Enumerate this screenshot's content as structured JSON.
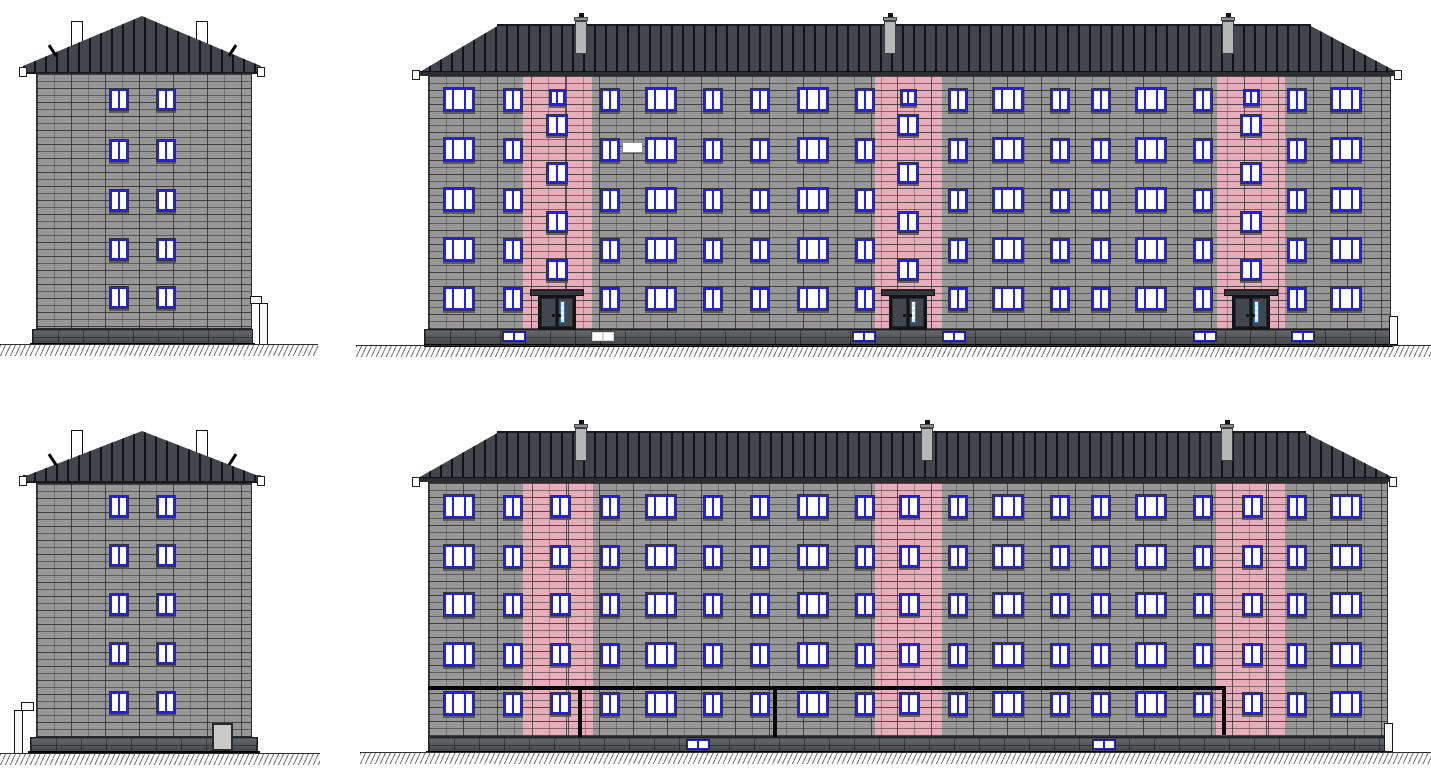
{
  "title": "Five-storey panel apartment building - elevation drawings: end elevation, street (entrance) elevation, opposite end elevation, rear elevation with gas pipe",
  "colors": {
    "wall_panel": "#979797",
    "panel_joint": "#3f3f3f",
    "stairwell_accent": "#e7adbb",
    "roof": "#43474d",
    "roof_seam": "#15171a",
    "fascia": "#2a2d32",
    "window_frame": "#2322e0",
    "window_pane": "#ffffff",
    "door_leaf": "#42474d",
    "door_glazing": "#cfe6f4",
    "plinth": "#54575b",
    "chimney": "#ffffff",
    "vent": "#b5b7b9",
    "gas_pipe": "#050505",
    "ground_line": "#2e2e2e"
  },
  "views": [
    {
      "id": "end-elevation-top",
      "kind": "end",
      "roof": {
        "tri": {
          "x": 23,
          "y": 16,
          "w": 238,
          "h": 50
        },
        "band": {
          "x": 23,
          "y": 66,
          "w": 238,
          "h": 8
        }
      },
      "chimneys": [
        {
          "x": 71,
          "y": 21,
          "w": 12,
          "h": 30
        },
        {
          "x": 196,
          "y": 21,
          "w": 12,
          "h": 30
        }
      ],
      "hooks": [
        {
          "x": 51,
          "y": 44,
          "rot": -33
        },
        {
          "x": 231,
          "y": 44,
          "rot": 33
        }
      ],
      "gutter_caps": [
        {
          "x": 19,
          "y": 67,
          "w": 8,
          "h": 10
        },
        {
          "x": 257,
          "y": 67,
          "w": 8,
          "h": 10
        }
      ],
      "wall": {
        "x": 36,
        "y": 73,
        "w": 216,
        "h": 256
      },
      "window_cols": [
        109,
        156
      ],
      "window": {
        "w": 20,
        "h": 23
      },
      "floors": [
        88,
        139,
        189,
        238,
        286
      ],
      "plinth": {
        "x": 32,
        "y": 329,
        "w": 221,
        "h": 15
      },
      "base_line": {
        "x": 30,
        "y": 343,
        "w": 225,
        "h": 2
      },
      "downspout": {
        "pipe": {
          "x": 259,
          "y": 303,
          "w": 9,
          "h": 42
        },
        "elbow": {
          "x": 250,
          "y": 296,
          "w": 12,
          "h": 8
        }
      },
      "ground": {
        "x": 0,
        "y": 344,
        "w": 318,
        "h": 12
      }
    },
    {
      "id": "front-elevation",
      "kind": "long",
      "roof": {
        "x": 418,
        "y": 25,
        "w": 981,
        "h": 48,
        "inset_left": 81,
        "inset_right": 90
      },
      "ridge": {
        "x": 497,
        "y": 24,
        "w": 814,
        "h": 2
      },
      "vents": [
        {
          "x": 575
        },
        {
          "x": 884
        },
        {
          "x": 1222
        }
      ],
      "vent_y": 19,
      "fascia": {
        "x": 418,
        "y": 71,
        "w": 981,
        "h": 5
      },
      "gutter_caps": [
        {
          "x": 412,
          "y": 70,
          "w": 8,
          "h": 10
        },
        {
          "x": 1394,
          "y": 70,
          "w": 8,
          "h": 10
        }
      ],
      "wall": {
        "x": 428,
        "y": 75,
        "w": 963,
        "h": 255
      },
      "stripes": [
        {
          "x": 523,
          "w": 69
        },
        {
          "x": 875,
          "w": 67
        },
        {
          "x": 1217,
          "w": 68
        }
      ],
      "window_cols": [
        {
          "x": 443,
          "t": 3
        },
        {
          "x": 503,
          "t": 2
        },
        {
          "x": 600,
          "t": 2
        },
        {
          "x": 645,
          "t": 3
        },
        {
          "x": 703,
          "t": 2
        },
        {
          "x": 750,
          "t": 2
        },
        {
          "x": 797,
          "t": 3
        },
        {
          "x": 855,
          "t": 2
        },
        {
          "x": 948,
          "t": 2
        },
        {
          "x": 992,
          "t": 3
        },
        {
          "x": 1050,
          "t": 2
        },
        {
          "x": 1091,
          "t": 2
        },
        {
          "x": 1135,
          "t": 3
        },
        {
          "x": 1193,
          "t": 2
        },
        {
          "x": 1287,
          "t": 2
        },
        {
          "x": 1330,
          "t": 3
        }
      ],
      "floors": [
        88,
        138,
        188,
        238,
        287
      ],
      "window_sizes": {
        "wide": {
          "w": 32,
          "h": 25
        },
        "narrow": {
          "w": 20,
          "h": 24
        }
      },
      "stair": {
        "mode": "offset",
        "centers": [
          557,
          908,
          1251
        ],
        "w": 22,
        "h": 22,
        "ys": [
          114,
          162,
          211,
          259
        ],
        "top_small": {
          "w": 17,
          "h": 17,
          "y": 89
        }
      },
      "doors": {
        "centers": [
          557,
          908,
          1251
        ],
        "w": 38,
        "y": 295,
        "h": 35,
        "canopy_w": 54,
        "canopy_y": 289,
        "canopy_h": 7
      },
      "blank_patch": {
        "x": 622,
        "y": 142,
        "w": 21,
        "h": 11
      },
      "plinth": {
        "x": 424,
        "y": 329,
        "w": 969,
        "h": 16
      },
      "base_line": {
        "x": 424,
        "y": 344,
        "w": 969,
        "h": 3
      },
      "basement_y": 331,
      "basement_windows": [
        {
          "x": 502,
          "style": "blue"
        },
        {
          "x": 591,
          "style": "white"
        },
        {
          "x": 852,
          "style": "blue"
        },
        {
          "x": 942,
          "style": "blue"
        },
        {
          "x": 1193,
          "style": "blue"
        },
        {
          "x": 1291,
          "style": "blue"
        }
      ],
      "downspout": {
        "pipe": {
          "x": 1389,
          "y": 316,
          "w": 9,
          "h": 29
        }
      },
      "ground": {
        "x": 356,
        "y": 345,
        "w": 1075,
        "h": 12
      }
    },
    {
      "id": "end-elevation-bottom",
      "kind": "end",
      "roof": {
        "tri": {
          "x": 23,
          "y": 431,
          "w": 238,
          "h": 46
        },
        "band": {
          "x": 23,
          "y": 475,
          "w": 238,
          "h": 8
        }
      },
      "chimneys": [
        {
          "x": 71,
          "y": 430,
          "w": 12,
          "h": 30
        },
        {
          "x": 196,
          "y": 430,
          "w": 12,
          "h": 30
        }
      ],
      "hooks": [
        {
          "x": 51,
          "y": 453,
          "rot": -33
        },
        {
          "x": 231,
          "y": 453,
          "rot": 33
        }
      ],
      "gutter_caps": [
        {
          "x": 19,
          "y": 476,
          "w": 8,
          "h": 10
        },
        {
          "x": 257,
          "y": 476,
          "w": 8,
          "h": 10
        }
      ],
      "wall": {
        "x": 36,
        "y": 483,
        "w": 216,
        "h": 254
      },
      "window_cols": [
        109,
        156
      ],
      "window": {
        "w": 20,
        "h": 23
      },
      "floors": [
        495,
        544,
        593,
        642,
        691
      ],
      "plinth": {
        "x": 30,
        "y": 737,
        "w": 228,
        "h": 15
      },
      "base_line": {
        "x": 28,
        "y": 751,
        "w": 232,
        "h": 2
      },
      "hatch_door": {
        "x": 212,
        "y": 723,
        "w": 21,
        "h": 28
      },
      "downspout": {
        "pipe": {
          "x": 14,
          "y": 710,
          "w": 9,
          "h": 44
        },
        "elbow": {
          "x": 21,
          "y": 702,
          "w": 13,
          "h": 9
        }
      },
      "ground": {
        "x": 0,
        "y": 753,
        "w": 320,
        "h": 12
      }
    },
    {
      "id": "rear-elevation",
      "kind": "long",
      "roof": {
        "x": 418,
        "y": 432,
        "w": 976,
        "h": 46,
        "inset_left": 81,
        "inset_right": 90
      },
      "ridge": {
        "x": 497,
        "y": 431,
        "w": 809,
        "h": 2
      },
      "vents": [
        {
          "x": 575
        },
        {
          "x": 921
        },
        {
          "x": 1221
        }
      ],
      "vent_y": 426,
      "fascia": {
        "x": 418,
        "y": 477,
        "w": 976,
        "h": 5
      },
      "gutter_caps": [
        {
          "x": 412,
          "y": 477,
          "w": 8,
          "h": 10
        },
        {
          "x": 1389,
          "y": 477,
          "w": 8,
          "h": 10
        }
      ],
      "wall": {
        "x": 428,
        "y": 482,
        "w": 960,
        "h": 255
      },
      "stripes": [
        {
          "x": 523,
          "w": 70
        },
        {
          "x": 875,
          "w": 67
        },
        {
          "x": 1215,
          "w": 70
        }
      ],
      "window_cols": [
        {
          "x": 443,
          "t": 3
        },
        {
          "x": 503,
          "t": 2
        },
        {
          "x": 600,
          "t": 2
        },
        {
          "x": 645,
          "t": 3
        },
        {
          "x": 703,
          "t": 2
        },
        {
          "x": 750,
          "t": 2
        },
        {
          "x": 797,
          "t": 3
        },
        {
          "x": 855,
          "t": 2
        },
        {
          "x": 948,
          "t": 2
        },
        {
          "x": 992,
          "t": 3
        },
        {
          "x": 1050,
          "t": 2
        },
        {
          "x": 1091,
          "t": 2
        },
        {
          "x": 1135,
          "t": 3
        },
        {
          "x": 1193,
          "t": 2
        },
        {
          "x": 1287,
          "t": 2
        },
        {
          "x": 1330,
          "t": 3
        }
      ],
      "floors": [
        495,
        545,
        593,
        643,
        692
      ],
      "window_sizes": {
        "wide": {
          "w": 32,
          "h": 25
        },
        "narrow": {
          "w": 20,
          "h": 24
        }
      },
      "stair": {
        "mode": "aligned",
        "centers": [
          560,
          909,
          1252
        ],
        "w": 21,
        "h": 23
      },
      "pipe": {
        "x1": 428,
        "x2": 1226,
        "y": 686,
        "h": 4,
        "drops": [
          {
            "x": 578,
            "y2": 737
          },
          {
            "x": 773,
            "y2": 737
          },
          {
            "x": 1222,
            "y2": 735
          }
        ]
      },
      "plinth": {
        "x": 428,
        "y": 737,
        "w": 960,
        "h": 15
      },
      "base_line": {
        "x": 426,
        "y": 751,
        "w": 966,
        "h": 2
      },
      "basement_y": 739,
      "basement_windows": [
        {
          "x": 686,
          "style": "blue"
        },
        {
          "x": 1092,
          "style": "blue"
        }
      ],
      "downspout": {
        "pipe": {
          "x": 1384,
          "y": 723,
          "w": 9,
          "h": 29
        }
      },
      "ground": {
        "x": 360,
        "y": 752,
        "w": 1071,
        "h": 12
      }
    }
  ]
}
